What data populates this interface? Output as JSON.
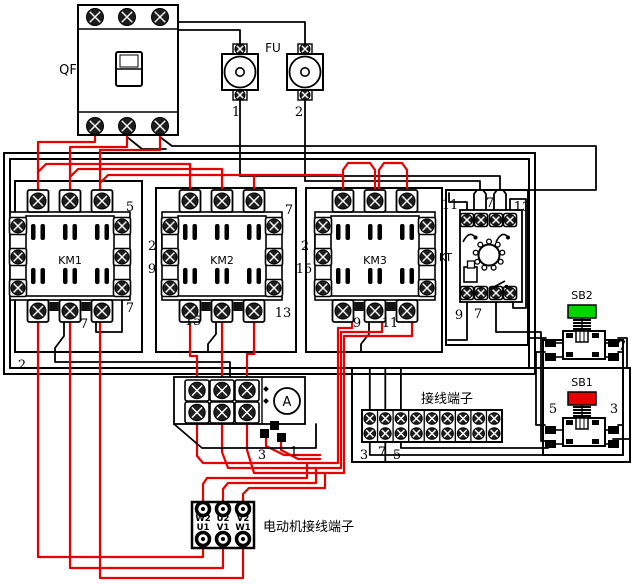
{
  "canvas": {
    "w": 640,
    "h": 588,
    "bg": "#ffffff"
  },
  "colors": {
    "wire_red": "#e80000",
    "line": "#000000",
    "sb2_cap": "#00d400",
    "sb1_cap": "#e80000"
  },
  "qf": {
    "label": "QF",
    "x": 78,
    "y": 5,
    "w": 100,
    "h": 130,
    "screw_xs": [
      95,
      127,
      160
    ]
  },
  "fu": {
    "label": "FU",
    "top": 54,
    "units": [
      {
        "num": "1",
        "cx": 240
      },
      {
        "num": "2",
        "cx": 305
      }
    ]
  },
  "contactors": [
    {
      "label": "KM1",
      "x": 10,
      "y": 212
    },
    {
      "label": "KM2",
      "x": 162,
      "y": 212
    },
    {
      "label": "KM3",
      "x": 315,
      "y": 212
    }
  ],
  "kt": {
    "label": "KT",
    "x": 460,
    "y": 210,
    "w": 62,
    "h": 92,
    "term_cx": [
      467,
      481,
      496,
      510
    ]
  },
  "sb": [
    {
      "label": "SB2",
      "top": 305,
      "cap": "#00d400"
    },
    {
      "label": "SB1",
      "top": 392,
      "cap": "#e80000"
    }
  ],
  "strip": {
    "label": "接线端子",
    "x": 362,
    "y": 410,
    "w": 140,
    "h": 32,
    "cols": 9
  },
  "motor": {
    "label": "电动机接线端子",
    "x": 192,
    "y": 502,
    "w": 62,
    "h": 46,
    "top_row": [
      "W2",
      "U2",
      "V2"
    ],
    "bottom_row": [
      "U1",
      "V1",
      "W1"
    ],
    "pin_xs": [
      203,
      223,
      243
    ]
  },
  "meter": {
    "label": "A",
    "cx": 287,
    "cy": 401,
    "r": 13,
    "panel": [
      174,
      377,
      131,
      47
    ]
  },
  "boxes": [
    [
      4,
      153,
      531,
      221
    ],
    [
      10,
      159,
      519,
      209
    ],
    [
      15,
      181,
      127,
      171
    ],
    [
      156,
      188,
      140,
      164
    ],
    [
      306,
      188,
      136,
      164
    ],
    [
      446,
      190,
      82,
      155
    ],
    [
      352,
      368,
      278,
      94
    ],
    [
      543,
      340,
      80,
      115
    ]
  ],
  "labels": [
    {
      "t": "5",
      "x": 130,
      "y": 211
    },
    {
      "t": "7",
      "x": 289,
      "y": 214
    },
    {
      "t": "7",
      "x": 130,
      "y": 312
    },
    {
      "t": "7",
      "x": 84,
      "y": 328
    },
    {
      "t": "2",
      "x": 152,
      "y": 250
    },
    {
      "t": "9",
      "x": 152,
      "y": 273
    },
    {
      "t": "15",
      "x": 193,
      "y": 325
    },
    {
      "t": "13",
      "x": 283,
      "y": 317
    },
    {
      "t": "2",
      "x": 305,
      "y": 250
    },
    {
      "t": "15",
      "x": 304,
      "y": 273
    },
    {
      "t": "9",
      "x": 357,
      "y": 327
    },
    {
      "t": "11",
      "x": 390,
      "y": 327
    },
    {
      "t": "11",
      "x": 450,
      "y": 209
    },
    {
      "t": "7",
      "x": 490,
      "y": 207
    },
    {
      "t": "13",
      "x": 522,
      "y": 211
    },
    {
      "t": "9",
      "x": 459,
      "y": 319
    },
    {
      "t": "7",
      "x": 478,
      "y": 318
    },
    {
      "t": "7",
      "x": 622,
      "y": 350
    },
    {
      "t": "5",
      "x": 553,
      "y": 413
    },
    {
      "t": "3",
      "x": 614,
      "y": 413
    },
    {
      "t": "3",
      "x": 262,
      "y": 459
    },
    {
      "t": "1",
      "x": 294,
      "y": 456
    },
    {
      "t": "3",
      "x": 364,
      "y": 459
    },
    {
      "t": "7",
      "x": 382,
      "y": 456
    },
    {
      "t": "5",
      "x": 397,
      "y": 459
    },
    {
      "t": "2",
      "x": 22,
      "y": 369
    },
    {
      "t": "1",
      "x": 236,
      "y": 116
    },
    {
      "t": "2",
      "x": 299,
      "y": 116
    }
  ],
  "black_wires": [
    [
      [
        178,
        22
      ],
      [
        305,
        22
      ],
      [
        305,
        45
      ]
    ],
    [
      [
        178,
        30
      ],
      [
        240,
        30
      ],
      [
        240,
        45
      ]
    ],
    [
      [
        240,
        100
      ],
      [
        240,
        176
      ]
    ],
    [
      [
        305,
        100
      ],
      [
        305,
        181
      ]
    ],
    [
      [
        240,
        176
      ],
      [
        500,
        176
      ],
      [
        500,
        190
      ]
    ],
    [
      [
        305,
        181
      ],
      [
        480,
        181
      ],
      [
        480,
        190
      ]
    ],
    [
      [
        474,
        213
      ],
      [
        474,
        194
      ],
      [
        477,
        190
      ],
      [
        483,
        190
      ],
      [
        486,
        194
      ],
      [
        486,
        213
      ]
    ],
    [
      [
        494,
        213
      ],
      [
        494,
        194
      ],
      [
        497,
        190
      ],
      [
        503,
        190
      ],
      [
        506,
        194
      ],
      [
        506,
        213
      ]
    ],
    [
      [
        510,
        213
      ],
      [
        510,
        199
      ],
      [
        526,
        199
      ],
      [
        526,
        308
      ],
      [
        513,
        308
      ],
      [
        513,
        300
      ]
    ],
    [
      [
        467,
        213
      ],
      [
        467,
        202
      ],
      [
        449,
        202
      ],
      [
        449,
        193
      ]
    ],
    [
      [
        467,
        300
      ],
      [
        467,
        340
      ],
      [
        448,
        340
      ]
    ],
    [
      [
        496,
        300
      ],
      [
        496,
        332
      ],
      [
        541,
        332
      ],
      [
        541,
        441
      ],
      [
        546,
        441
      ]
    ],
    [
      [
        160,
        137
      ],
      [
        172,
        146
      ],
      [
        596,
        146
      ],
      [
        596,
        190
      ],
      [
        529,
        190
      ]
    ],
    [
      [
        127,
        137
      ],
      [
        142,
        149
      ],
      [
        166,
        149
      ]
    ],
    [
      [
        528,
        338
      ],
      [
        546,
        338
      ]
    ],
    [
      [
        618,
        338
      ],
      [
        627,
        338
      ],
      [
        627,
        368
      ]
    ],
    [
      [
        618,
        352
      ],
      [
        623,
        352
      ]
    ],
    [
      [
        545,
        352
      ],
      [
        536,
        352
      ],
      [
        536,
        425
      ],
      [
        545,
        425
      ]
    ],
    [
      [
        618,
        425
      ],
      [
        623,
        425
      ]
    ],
    [
      [
        613,
        439
      ],
      [
        630,
        439
      ]
    ],
    [
      [
        369.8,
        411
      ],
      [
        369.8,
        368
      ]
    ],
    [
      [
        385.3,
        411
      ],
      [
        385.3,
        368
      ]
    ],
    [
      [
        400.9,
        411
      ],
      [
        400.9,
        368
      ]
    ],
    [
      [
        369.8,
        441
      ],
      [
        369.8,
        455
      ],
      [
        543,
        455
      ]
    ],
    [
      [
        385.3,
        441
      ],
      [
        385.3,
        462
      ]
    ],
    [
      [
        400.9,
        441
      ],
      [
        400.9,
        448
      ],
      [
        548,
        448
      ],
      [
        548,
        443
      ]
    ],
    [
      [
        170,
        226
      ],
      [
        162,
        226
      ],
      [
        162,
        257
      ],
      [
        170,
        257
      ]
    ],
    [
      [
        323,
        226
      ],
      [
        315,
        226
      ],
      [
        315,
        257
      ],
      [
        323,
        257
      ]
    ],
    [
      [
        64,
        322
      ],
      [
        64,
        336
      ],
      [
        55,
        348
      ],
      [
        55,
        362
      ],
      [
        230,
        362
      ],
      [
        230,
        377
      ]
    ],
    [
      [
        96,
        322
      ],
      [
        96,
        332
      ],
      [
        122,
        332
      ],
      [
        122,
        297
      ]
    ],
    [
      [
        216,
        322
      ],
      [
        216,
        334
      ],
      [
        208,
        344
      ],
      [
        208,
        352
      ]
    ],
    [
      [
        369,
        322
      ],
      [
        369,
        334
      ],
      [
        361,
        344
      ],
      [
        361,
        352
      ]
    ]
  ],
  "red_wires": [
    [
      [
        95,
        136
      ],
      [
        95,
        142
      ],
      [
        38,
        142
      ],
      [
        38,
        198
      ]
    ],
    [
      [
        127,
        136
      ],
      [
        127,
        147
      ],
      [
        70,
        147
      ],
      [
        70,
        198
      ]
    ],
    [
      [
        160,
        136
      ],
      [
        160,
        150
      ],
      [
        100,
        150
      ],
      [
        100,
        198
      ]
    ],
    [
      [
        38,
        172
      ],
      [
        46,
        164
      ],
      [
        190,
        164
      ],
      [
        190,
        198
      ]
    ],
    [
      [
        70,
        177
      ],
      [
        78,
        169
      ],
      [
        222,
        169
      ],
      [
        222,
        198
      ]
    ],
    [
      [
        100,
        183
      ],
      [
        108,
        175
      ],
      [
        254,
        175
      ],
      [
        254,
        198
      ]
    ],
    [
      [
        254,
        175
      ],
      [
        343,
        175
      ],
      [
        343,
        198
      ]
    ],
    [
      [
        343,
        198
      ],
      [
        343,
        170
      ],
      [
        348,
        163
      ],
      [
        370,
        163
      ],
      [
        375,
        170
      ],
      [
        375,
        198
      ]
    ],
    [
      [
        379,
        198
      ],
      [
        379,
        170
      ],
      [
        384,
        163
      ],
      [
        402,
        163
      ],
      [
        407,
        170
      ],
      [
        407,
        198
      ]
    ],
    [
      [
        38,
        320
      ],
      [
        38,
        557
      ],
      [
        203,
        557
      ],
      [
        203,
        544
      ]
    ],
    [
      [
        70,
        320
      ],
      [
        70,
        568
      ],
      [
        223,
        568
      ],
      [
        223,
        544
      ]
    ],
    [
      [
        100,
        320
      ],
      [
        100,
        578
      ],
      [
        243,
        578
      ],
      [
        243,
        544
      ]
    ],
    [
      [
        190,
        322
      ],
      [
        190,
        356
      ],
      [
        197,
        356
      ],
      [
        197,
        388
      ]
    ],
    [
      [
        222,
        322
      ],
      [
        222,
        388
      ]
    ],
    [
      [
        254,
        322
      ],
      [
        254,
        354
      ],
      [
        247,
        354
      ],
      [
        247,
        388
      ]
    ],
    [
      [
        197,
        418
      ],
      [
        197,
        456
      ],
      [
        203,
        463
      ],
      [
        307,
        463
      ],
      [
        307,
        478
      ],
      [
        207,
        478
      ],
      [
        203,
        484
      ],
      [
        203,
        507
      ]
    ],
    [
      [
        222,
        418
      ],
      [
        222,
        452
      ],
      [
        228,
        468
      ],
      [
        316,
        468
      ],
      [
        316,
        483
      ],
      [
        228,
        483
      ],
      [
        223,
        489
      ],
      [
        223,
        507
      ]
    ],
    [
      [
        247,
        418
      ],
      [
        247,
        450
      ],
      [
        254,
        473
      ],
      [
        325,
        473
      ],
      [
        325,
        488
      ],
      [
        249,
        488
      ],
      [
        243,
        494
      ],
      [
        243,
        507
      ]
    ],
    [
      [
        352,
        320
      ],
      [
        352,
        328
      ],
      [
        338,
        328
      ],
      [
        338,
        463
      ],
      [
        306,
        463
      ]
    ],
    [
      [
        382,
        320
      ],
      [
        382,
        332
      ],
      [
        341,
        332
      ],
      [
        341,
        468
      ],
      [
        315,
        468
      ]
    ],
    [
      [
        412,
        320
      ],
      [
        412,
        336
      ],
      [
        344,
        336
      ],
      [
        344,
        473
      ],
      [
        324,
        473
      ]
    ],
    [
      [
        266,
        433
      ],
      [
        266,
        446
      ],
      [
        284,
        455
      ],
      [
        320,
        455
      ]
    ],
    [
      [
        281,
        440
      ],
      [
        281,
        450
      ],
      [
        298,
        459
      ],
      [
        320,
        459
      ]
    ]
  ]
}
